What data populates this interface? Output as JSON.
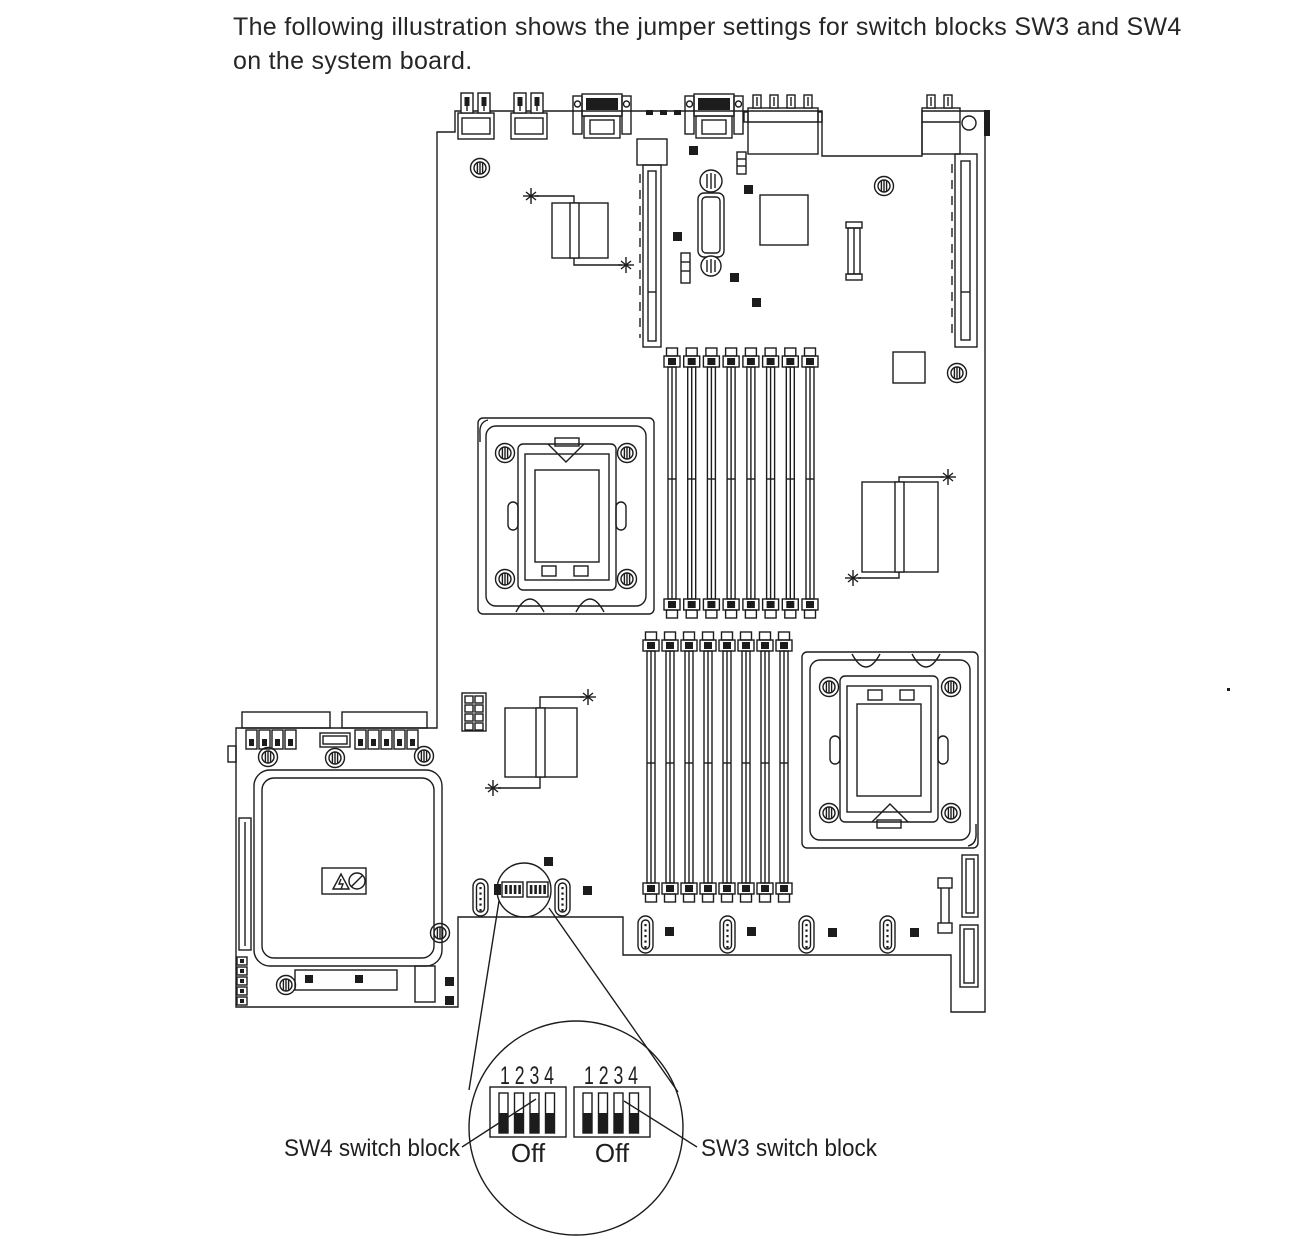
{
  "colors": {
    "background": "#ffffff",
    "line": "#1c1c1c",
    "switch_actuator": "#111111"
  },
  "caption": {
    "line1": "The following illustration shows the jumper settings for switch blocks SW3 and SW4",
    "line2": "on the system board."
  },
  "board": {
    "cpu_sockets": 2,
    "dimm_banks": 2,
    "dimm_slots_per_bank": 8,
    "switch_blocks_shown": [
      "SW4",
      "SW3"
    ]
  },
  "magnifier": {
    "blocks": [
      {
        "id": "SW4",
        "numbers": "1 2 3 4",
        "state_label": "Off",
        "switch_positions": [
          "off",
          "off",
          "off",
          "off"
        ],
        "callout": "SW4 switch block"
      },
      {
        "id": "SW3",
        "numbers": "1 2 3 4",
        "state_label": "Off",
        "switch_positions": [
          "off",
          "off",
          "off",
          "off"
        ],
        "callout": "SW3 switch block"
      }
    ]
  },
  "icons": {
    "hazard": "electrical-hazard-icon",
    "no_touch": "no-touch-icon",
    "screw": "screw-hole-icon",
    "heatpipe_anchor": "heatpipe-anchor-icon"
  }
}
